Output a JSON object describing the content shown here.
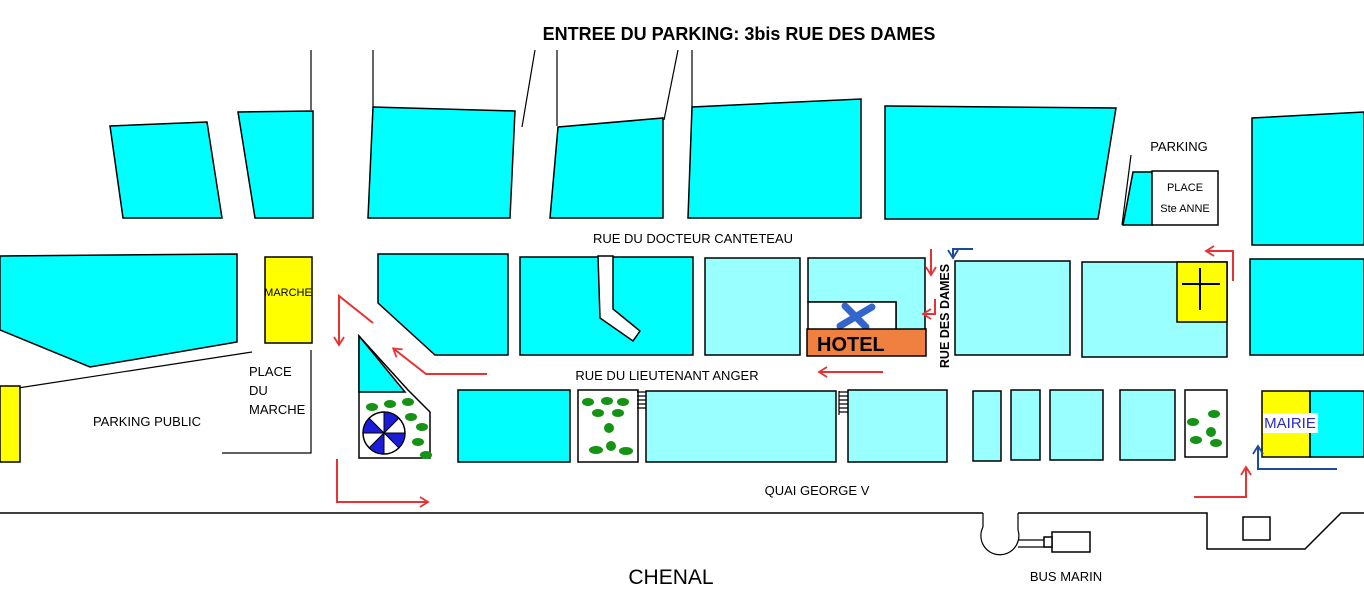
{
  "title": "ENTREE DU PARKING: 3bis RUE DES DAMES",
  "streets": {
    "canteteau": "RUE DU DOCTEUR CANTETEAU",
    "anger": "RUE DU LIEUTENANT ANGER",
    "dames": "RUE DES DAMES",
    "quai": "QUAI GEORGE V"
  },
  "areas": {
    "parking": "PARKING",
    "place_ste_anne": [
      "PLACE",
      "Ste ANNE"
    ],
    "place_du_marche": [
      "PLACE",
      "DU",
      "MARCHE"
    ],
    "parking_public": "PARKING PUBLIC",
    "chenal": "CHENAL",
    "bus_marin": "BUS MARIN"
  },
  "landmarks": {
    "marche": "MARCHE",
    "hotel": "HOTEL",
    "mairie": "MAIRIE"
  },
  "icons": {
    "hotel_marker": "blue-x-marker",
    "church": "cross",
    "carousel": "blue-white-pinwheel",
    "trees": "green-dots",
    "bus_pier": "round-pier-with-boat",
    "route_red": "red-direction-arrows",
    "route_blue": "blue-direction-arrows"
  },
  "colors": {
    "block_bright_cyan": "#00FFFF",
    "block_pale_cyan": "#99FFFF",
    "landmark_yellow": "#FFFF00",
    "hotel_orange": "#F08040",
    "route_red": "#E63232",
    "route_blue": "#1B4C99",
    "tree_green": "#149314",
    "carousel_blue": "#1C1CD8",
    "hotel_icon_blue": "#3366CC",
    "mairie_text_blue": "#2A2AC8",
    "outline_black": "#000000",
    "background": "#FFFFFF"
  }
}
